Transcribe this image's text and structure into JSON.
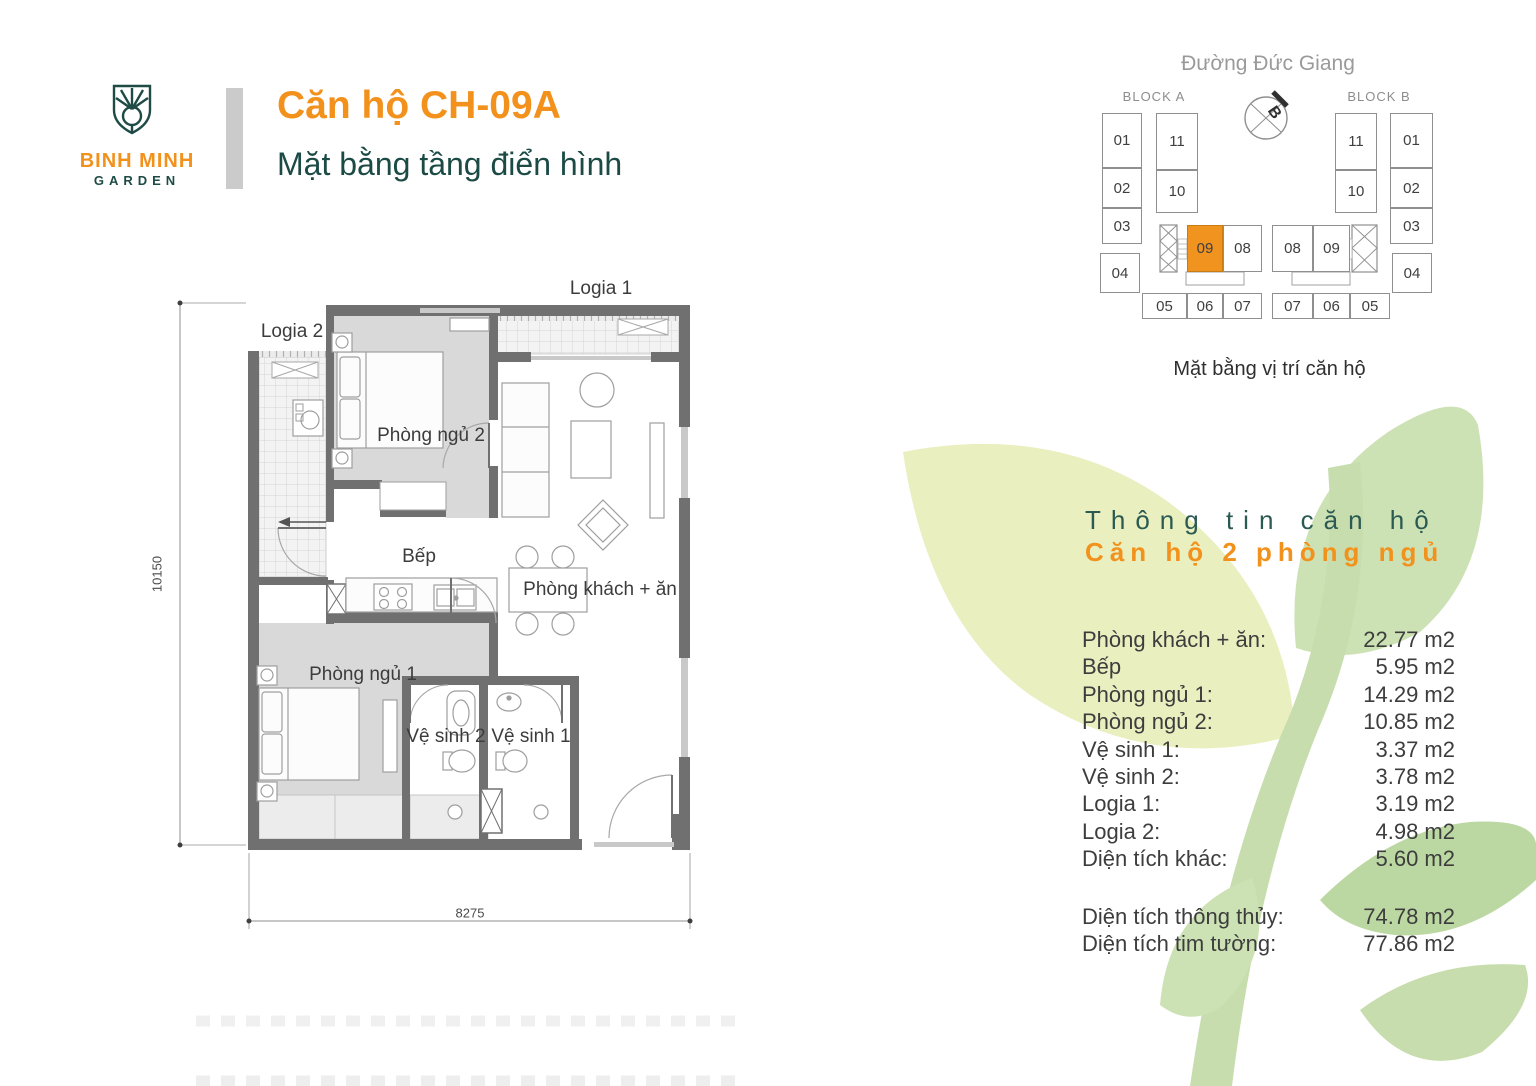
{
  "header": {
    "brand_line1": "BINH MINH",
    "brand_line2": "GARDEN",
    "title": "Căn hộ CH-09A",
    "subtitle": "Mặt bằng tầng điển hình"
  },
  "site_map": {
    "street": "Đường Đức Giang",
    "block_a": "BLOCK A",
    "block_b": "BLOCK B",
    "compass": "B",
    "caption": "Mặt bằng vị trí căn hộ",
    "highlight_color": "#F0931F",
    "units": [
      {
        "label": "01",
        "x": 1102,
        "y": 113,
        "w": 40,
        "h": 55
      },
      {
        "label": "02",
        "x": 1102,
        "y": 168,
        "w": 40,
        "h": 40
      },
      {
        "label": "03",
        "x": 1102,
        "y": 208,
        "w": 40,
        "h": 36
      },
      {
        "label": "04",
        "x": 1100,
        "y": 253,
        "w": 40,
        "h": 40
      },
      {
        "label": "11",
        "x": 1156,
        "y": 113,
        "w": 42,
        "h": 57
      },
      {
        "label": "10",
        "x": 1156,
        "y": 170,
        "w": 42,
        "h": 43
      },
      {
        "label": "09",
        "x": 1187,
        "y": 225,
        "w": 36,
        "h": 47,
        "highlight": true
      },
      {
        "label": "08",
        "x": 1223,
        "y": 225,
        "w": 39,
        "h": 47
      },
      {
        "label": "08",
        "x": 1272,
        "y": 225,
        "w": 41,
        "h": 47
      },
      {
        "label": "09",
        "x": 1313,
        "y": 225,
        "w": 37,
        "h": 47
      },
      {
        "label": "05",
        "x": 1142,
        "y": 293,
        "w": 45,
        "h": 26
      },
      {
        "label": "06",
        "x": 1187,
        "y": 293,
        "w": 36,
        "h": 26
      },
      {
        "label": "07",
        "x": 1223,
        "y": 293,
        "w": 39,
        "h": 26
      },
      {
        "label": "07",
        "x": 1272,
        "y": 293,
        "w": 41,
        "h": 26
      },
      {
        "label": "06",
        "x": 1313,
        "y": 293,
        "w": 37,
        "h": 26
      },
      {
        "label": "05",
        "x": 1350,
        "y": 293,
        "w": 40,
        "h": 26
      },
      {
        "label": "11",
        "x": 1335,
        "y": 113,
        "w": 42,
        "h": 57
      },
      {
        "label": "10",
        "x": 1335,
        "y": 170,
        "w": 42,
        "h": 43
      },
      {
        "label": "01",
        "x": 1390,
        "y": 113,
        "w": 43,
        "h": 55
      },
      {
        "label": "02",
        "x": 1390,
        "y": 168,
        "w": 43,
        "h": 40
      },
      {
        "label": "03",
        "x": 1390,
        "y": 208,
        "w": 43,
        "h": 36
      },
      {
        "label": "04",
        "x": 1392,
        "y": 253,
        "w": 40,
        "h": 40
      }
    ]
  },
  "floor_plan": {
    "labels": [
      {
        "text": "Logia 1",
        "x": 601,
        "y": 289
      },
      {
        "text": "Logia 2",
        "x": 292,
        "y": 332
      },
      {
        "text": "Phòng ngủ 2",
        "x": 431,
        "y": 436
      },
      {
        "text": "Bếp",
        "x": 419,
        "y": 557
      },
      {
        "text": "Phòng khách + ăn",
        "x": 600,
        "y": 590
      },
      {
        "text": "Phòng ngủ 1",
        "x": 363,
        "y": 675
      },
      {
        "text": "Vệ sinh 2",
        "x": 446,
        "y": 737
      },
      {
        "text": "Vệ sinh 1",
        "x": 531,
        "y": 737
      }
    ],
    "dimensions": [
      {
        "text": "10150",
        "x": 157,
        "y": 574,
        "rot": true
      },
      {
        "text": "8275",
        "x": 470,
        "y": 913
      }
    ]
  },
  "info": {
    "heading": "Thông tin căn hộ",
    "subheading": "Căn hộ 2 phòng ngủ",
    "rows": [
      {
        "label": "Phòng khách + ăn:",
        "value": "22.77 m2"
      },
      {
        "label": "Bếp",
        "value": "5.95 m2"
      },
      {
        "label": "Phòng ngủ 1:",
        "value": "14.29 m2"
      },
      {
        "label": "Phòng ngủ 2:",
        "value": "10.85 m2"
      },
      {
        "label": "Vệ sinh 1:",
        "value": "3.37 m2"
      },
      {
        "label": "Vệ sinh 2:",
        "value": "3.78 m2"
      },
      {
        "label": "Logia 1:",
        "value": "3.19 m2"
      },
      {
        "label": "Logia 2:",
        "value": "4.98 m2"
      },
      {
        "label": "Diện tích khác:",
        "value": "5.60 m2"
      }
    ],
    "summary": [
      {
        "label": "Diện tích thông thủy:",
        "value": "74.78 m2"
      },
      {
        "label": "Diện tích tim tường:",
        "value": "77.86 m2"
      }
    ]
  },
  "colors": {
    "accent_orange": "#F2921D",
    "brand_teal": "#1C4B46",
    "wall_gray": "#707070"
  }
}
